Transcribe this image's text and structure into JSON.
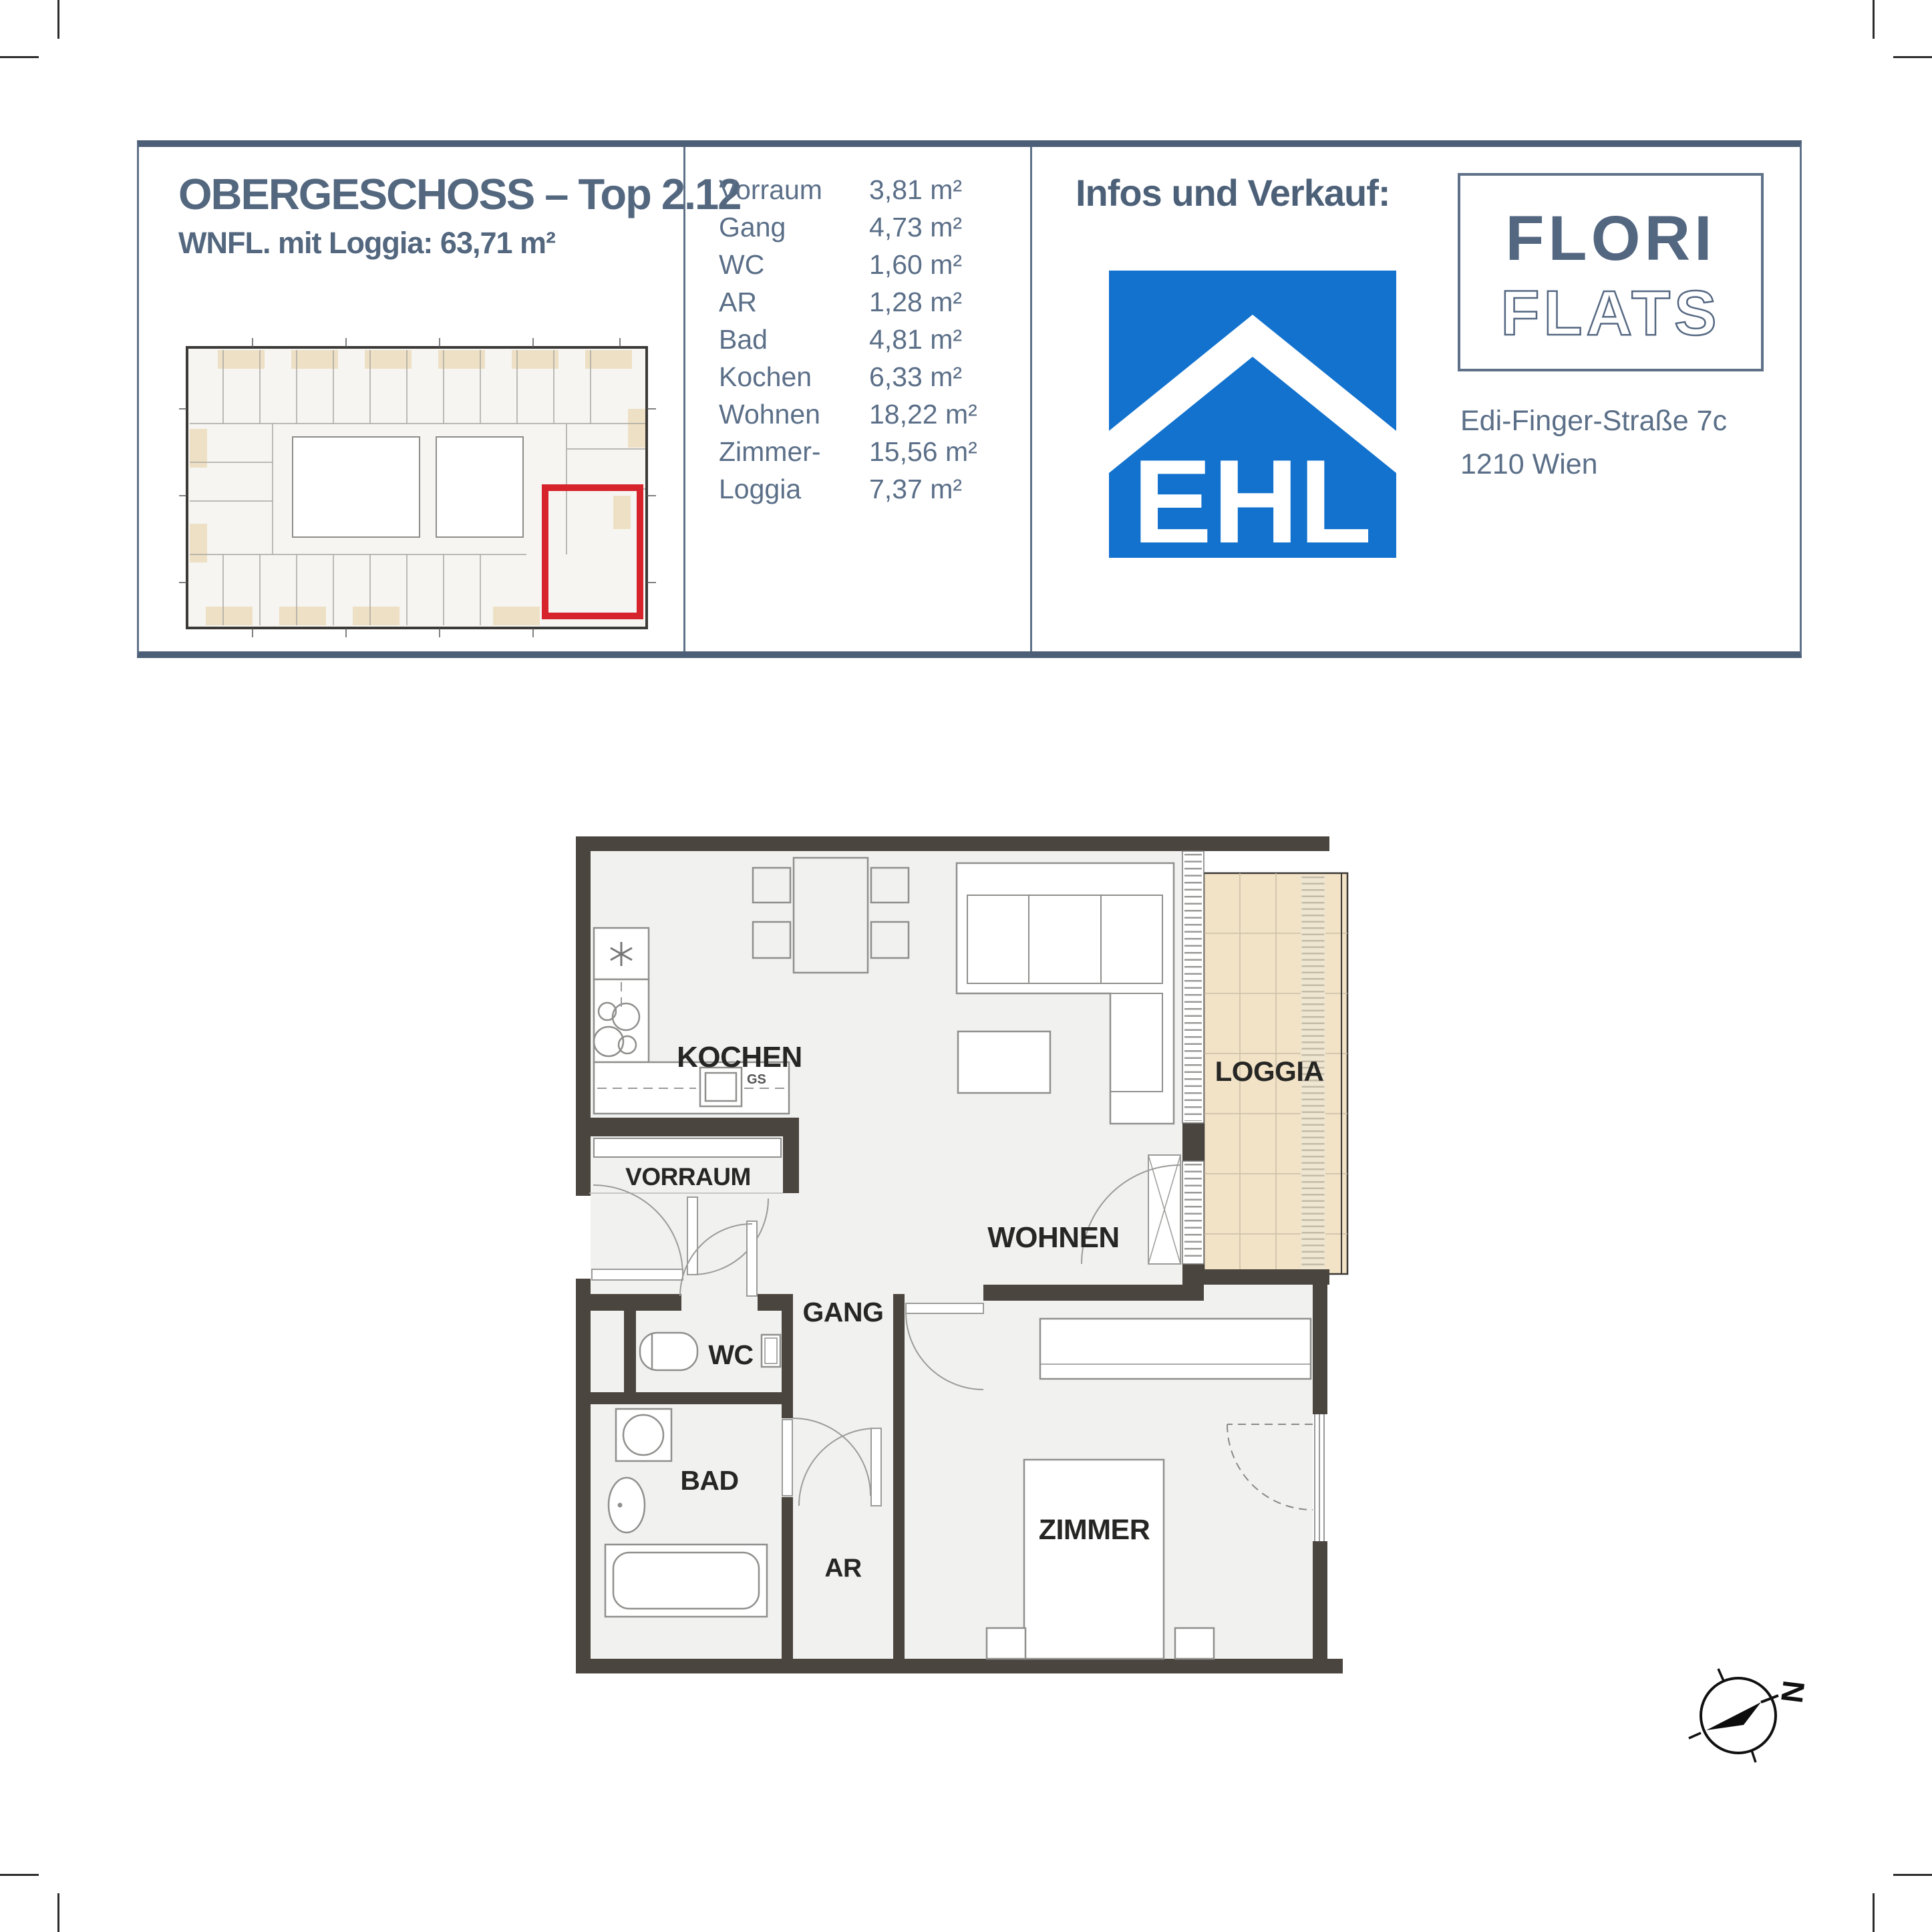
{
  "header": {
    "title": "OBERGESCHOSS – Top 2.12",
    "subtitle": "WNFL. mit Loggia: 63,71 m²",
    "area_table": {
      "rows": [
        {
          "label": "Vorraum",
          "value": "3,81 m²"
        },
        {
          "label": "Gang",
          "value": "4,73 m²"
        },
        {
          "label": "WC",
          "value": "1,60 m²"
        },
        {
          "label": "AR",
          "value": "1,28 m²"
        },
        {
          "label": "Bad",
          "value": "4,81 m²"
        },
        {
          "label": "Kochen",
          "value": "6,33 m²"
        },
        {
          "label": "Wohnen",
          "value": "18,22 m²"
        },
        {
          "label": "Zimmer-",
          "value": "15,56 m²"
        },
        {
          "label": "Loggia",
          "value": "7,37 m²"
        }
      ]
    },
    "sales": {
      "heading": "Infos und Verkauf:",
      "ehl_logo_text": "EHL",
      "brand_top": "FLORI",
      "brand_bottom": "FLATS",
      "address_line1": "Edi-Finger-Straße 7c",
      "address_line2": "1210 Wien"
    }
  },
  "floorplan": {
    "rooms": {
      "kochen": "KOCHEN",
      "wohnen": "WOHNEN",
      "loggia": "LOGGIA",
      "vorraum": "VORRAUM",
      "gang": "GANG",
      "wc": "WC",
      "bad": "BAD",
      "ar": "AR",
      "zimmer": "ZIMMER"
    },
    "appliance_labels": {
      "dishwasher": "GS"
    }
  },
  "compass": {
    "north_label": "N"
  },
  "colors": {
    "accent_slate": "#54687f",
    "ehl_blue": "#1272ce",
    "wall": "#4b453f",
    "loggia_beige": "#f2e2c6",
    "highlight_red": "#d7232b"
  }
}
